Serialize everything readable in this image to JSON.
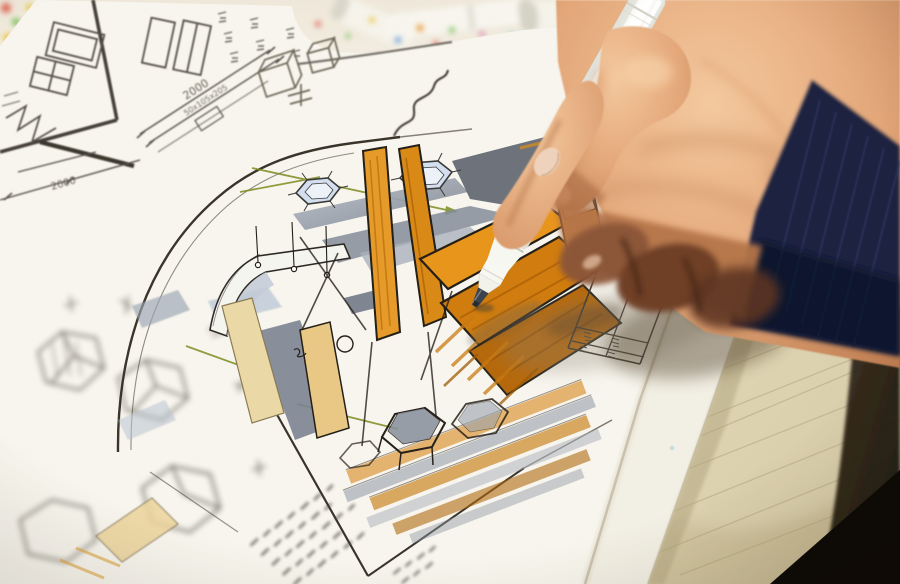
{
  "photo": {
    "subject": "hand-with-white-marker-drawing-interior-design-sketch",
    "objects": [
      "artist-hand",
      "white-marker-pen",
      "navy-sleeve-cuff",
      "concept-sketch",
      "dimension-notes",
      "title-block-table",
      "wooden-drawing-board",
      "marker-pens-on-desk",
      "color-test-dots"
    ]
  },
  "text_annotations": {
    "dim_top": "2000",
    "dim_spec": "50x105x205",
    "dim_left": "2000"
  },
  "colors": {
    "paper": "#f7f5ed",
    "desk": "#efe8da",
    "ink": "#241f17",
    "pencil": "#55504a",
    "marker_orange": "#e8951c",
    "marker_deep_orange": "#b46505",
    "marker_tan": "#ead9a6",
    "marker_gray": "#848c98",
    "lamp_blue": "#d3deee",
    "accent_green": "#7c8c20",
    "skin": "#e2a678",
    "skin_shadow": "#8a5538",
    "sleeve_navy": "#1a2140",
    "wood": "#d3c7a2",
    "pen_white": "#fbfbf7",
    "pen_nib": "#3d434c"
  }
}
